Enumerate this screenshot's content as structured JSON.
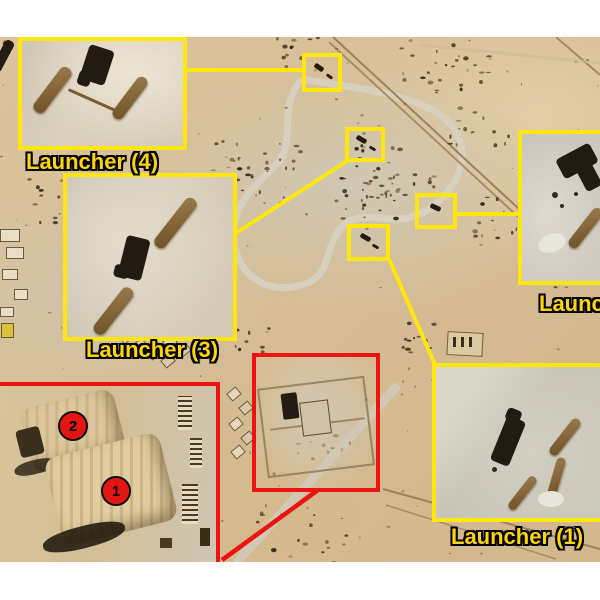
{
  "colors": {
    "annotation_yellow": "#ffe70d",
    "annotation_red": "#ea1410",
    "label_text_yellow": "#ffd60a",
    "sand": "#d8bf97"
  },
  "insets": {
    "launcher4": {
      "label": "Launcher (4)"
    },
    "launcher3": {
      "label": "Launcher (3)"
    },
    "launcher2": {
      "label": "Launcher (2)"
    },
    "launcher1": {
      "label": "Launcher (1)"
    }
  },
  "markers": {
    "hangar1": "1",
    "hangar2": "2"
  }
}
